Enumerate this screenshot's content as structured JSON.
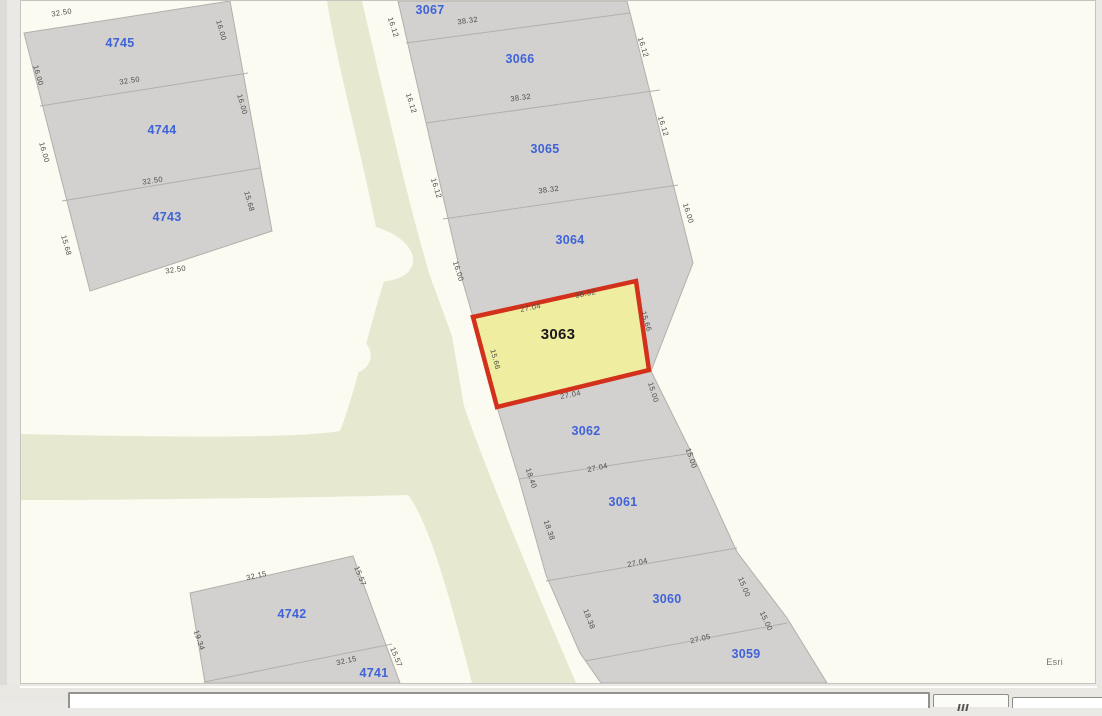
{
  "map": {
    "attribution": "Esri",
    "selected_parcel": {
      "id": "3063"
    },
    "colors": {
      "map_background": "#fbfbf2",
      "page_background": "#eae9e5",
      "road_green": "#e6e9cf",
      "parcel_fill": "#d2d1cf",
      "parcel_border": "#b1b0ac",
      "selected_fill": "#eeeda0",
      "selected_border": "#d3311c",
      "parcel_label_blue": "#3f63d8",
      "selected_label_color": "#1a1a1a",
      "dim_label_color": "#4b4b47"
    },
    "parcel_labels": [
      {
        "id": "4745",
        "text": "4745",
        "x": 120,
        "y": 46
      },
      {
        "id": "4744",
        "text": "4744",
        "x": 162,
        "y": 133
      },
      {
        "id": "4743",
        "text": "4743",
        "x": 167,
        "y": 220
      },
      {
        "id": "3067",
        "text": "3067",
        "x": 430,
        "y": 13
      },
      {
        "id": "3066",
        "text": "3066",
        "x": 520,
        "y": 62
      },
      {
        "id": "3065",
        "text": "3065",
        "x": 545,
        "y": 152
      },
      {
        "id": "3064",
        "text": "3064",
        "x": 570,
        "y": 243
      },
      {
        "id": "3063",
        "text": "3063",
        "x": 558,
        "y": 338
      },
      {
        "id": "3062",
        "text": "3062",
        "x": 586,
        "y": 434
      },
      {
        "id": "3061",
        "text": "3061",
        "x": 623,
        "y": 505
      },
      {
        "id": "3060",
        "text": "3060",
        "x": 667,
        "y": 602
      },
      {
        "id": "3059",
        "text": "3059",
        "x": 746,
        "y": 657
      },
      {
        "id": "4742",
        "text": "4742",
        "x": 292,
        "y": 617
      },
      {
        "id": "4741",
        "text": "4741",
        "x": 374,
        "y": 676
      }
    ],
    "dim_labels": [
      {
        "text": "32.50",
        "x": 62,
        "y": 14,
        "rot": -9
      },
      {
        "text": "16.00",
        "x": 36,
        "y": 75,
        "rot": 74
      },
      {
        "text": "16.00",
        "x": 219,
        "y": 30,
        "rot": 74
      },
      {
        "text": "32.50",
        "x": 130,
        "y": 82,
        "rot": -9
      },
      {
        "text": "16.00",
        "x": 42,
        "y": 152,
        "rot": 74
      },
      {
        "text": "16.00",
        "x": 240,
        "y": 104,
        "rot": 74
      },
      {
        "text": "32.50",
        "x": 153,
        "y": 182,
        "rot": -9
      },
      {
        "text": "15.68",
        "x": 247,
        "y": 201,
        "rot": 74
      },
      {
        "text": "15.68",
        "x": 64,
        "y": 245,
        "rot": 74
      },
      {
        "text": "32.50",
        "x": 176,
        "y": 271,
        "rot": -9
      },
      {
        "text": "38.32",
        "x": 468,
        "y": 22,
        "rot": -8
      },
      {
        "text": "16.12",
        "x": 391,
        "y": 27,
        "rot": 72
      },
      {
        "text": "16.12",
        "x": 641,
        "y": 47,
        "rot": 72
      },
      {
        "text": "38.32",
        "x": 521,
        "y": 99,
        "rot": -8
      },
      {
        "text": "16.12",
        "x": 409,
        "y": 103,
        "rot": 72
      },
      {
        "text": "16.12",
        "x": 661,
        "y": 126,
        "rot": 72
      },
      {
        "text": "38.32",
        "x": 549,
        "y": 191,
        "rot": -8
      },
      {
        "text": "16.12",
        "x": 434,
        "y": 188,
        "rot": 72
      },
      {
        "text": "16.00",
        "x": 686,
        "y": 213,
        "rot": 72
      },
      {
        "text": "16.00",
        "x": 456,
        "y": 271,
        "rot": 72
      },
      {
        "text": "27.04",
        "x": 531,
        "y": 309,
        "rot": -11
      },
      {
        "text": "38.32",
        "x": 586,
        "y": 295,
        "rot": -11
      },
      {
        "text": "15.66",
        "x": 644,
        "y": 321,
        "rot": 73
      },
      {
        "text": "15.66",
        "x": 493,
        "y": 359,
        "rot": 75
      },
      {
        "text": "27.04",
        "x": 571,
        "y": 396,
        "rot": -11
      },
      {
        "text": "15.00",
        "x": 651,
        "y": 392,
        "rot": 73
      },
      {
        "text": "18.40",
        "x": 529,
        "y": 478,
        "rot": 71
      },
      {
        "text": "27.04",
        "x": 598,
        "y": 469,
        "rot": -12
      },
      {
        "text": "15.00",
        "x": 689,
        "y": 458,
        "rot": 71
      },
      {
        "text": "18.38",
        "x": 547,
        "y": 530,
        "rot": 71
      },
      {
        "text": "27.04",
        "x": 638,
        "y": 564,
        "rot": -12
      },
      {
        "text": "15.00",
        "x": 742,
        "y": 587,
        "rot": 67
      },
      {
        "text": "18.38",
        "x": 587,
        "y": 619,
        "rot": 69
      },
      {
        "text": "27.05",
        "x": 701,
        "y": 640,
        "rot": -14
      },
      {
        "text": "15.00",
        "x": 764,
        "y": 621,
        "rot": 65
      },
      {
        "text": "32.15",
        "x": 257,
        "y": 577,
        "rot": -13
      },
      {
        "text": "15.57",
        "x": 358,
        "y": 576,
        "rot": 68
      },
      {
        "text": "19.34",
        "x": 197,
        "y": 640,
        "rot": 71
      },
      {
        "text": "32.15",
        "x": 347,
        "y": 662,
        "rot": -13
      },
      {
        "text": "15.57",
        "x": 394,
        "y": 657,
        "rot": 68
      }
    ]
  },
  "bottom_bar": {
    "icons": {
      "button_glyph": "grip-icon"
    }
  }
}
